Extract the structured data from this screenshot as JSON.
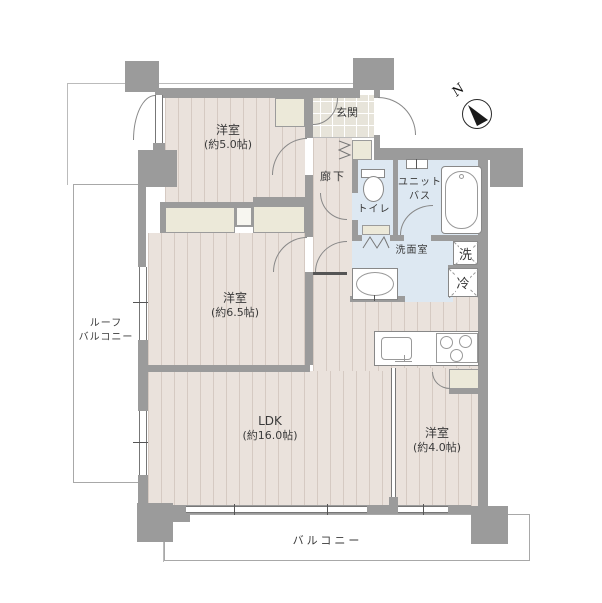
{
  "rooms": {
    "yoshitsu5": {
      "name": "洋室",
      "size": "(約5.0帖)"
    },
    "yoshitsu65": {
      "name": "洋室",
      "size": "(約6.5帖)"
    },
    "ldk": {
      "name": "LDK",
      "size": "(約16.0帖)"
    },
    "yoshitsu4": {
      "name": "洋室",
      "size": "(約4.0帖)"
    },
    "genkan": {
      "name": "玄関"
    },
    "rouka": {
      "name": "廊下"
    },
    "toilet": {
      "name": "トイレ"
    },
    "unitbath": {
      "line1": "ユニット",
      "line2": "バス"
    },
    "senmenshitsu": {
      "name": "洗面室"
    },
    "washer": {
      "name": "洗"
    },
    "fridge": {
      "name": "冷"
    },
    "balcony": {
      "name": "バルコニー"
    },
    "roof_balcony": {
      "line1": "ルーフ",
      "line2": "バルコニー"
    }
  },
  "compass": {
    "north": "N"
  },
  "colors": {
    "wall": "#9b9b9b",
    "floor": "#eae2dc",
    "wet_area": "#dde8f2",
    "closet": "#ece9d9",
    "entry_tile": "#e7e4da",
    "outline": "#888888"
  }
}
